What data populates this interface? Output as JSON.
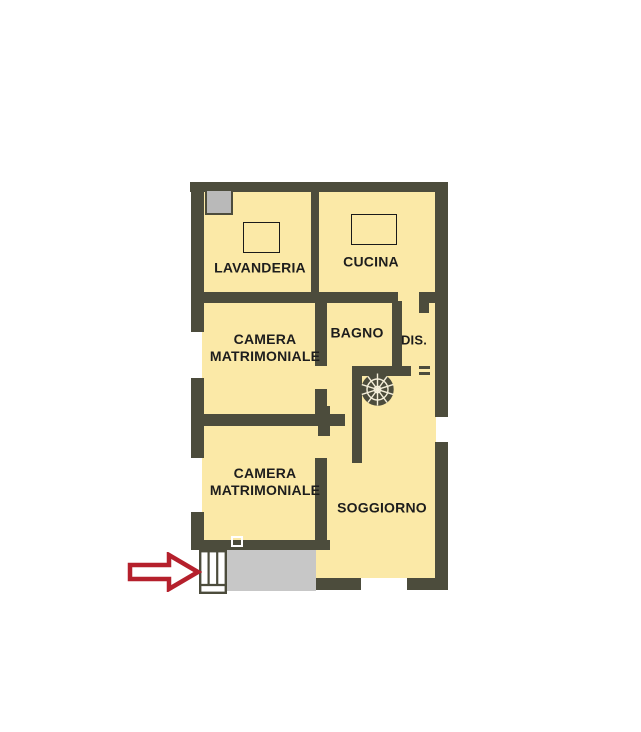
{
  "title": "Apartment floor plan",
  "colors": {
    "wall": "#4c4c3c",
    "room_fill": "#fbe9a7",
    "terrace": "#c7c7c7",
    "appliance": "#b9b9b9",
    "arrow_red": "#b5202c",
    "label_text": "#1d1d1d"
  },
  "rooms": {
    "lavanderia": {
      "label": "LAVANDERIA"
    },
    "cucina": {
      "label": "CUCINA"
    },
    "camera_matrimoniale_1": {
      "line1": "CAMERA",
      "line2": "MATRIMONIALE"
    },
    "bagno": {
      "label": "BAGNO"
    },
    "disimpegno": {
      "label": "DIS."
    },
    "camera_matrimoniale_2": {
      "line1": "CAMERA",
      "line2": "MATRIMONIALE"
    },
    "soggiorno": {
      "label": "SOGGIORNO"
    }
  },
  "icons": {
    "entrance_arrow": "red-block-arrow-right",
    "spiral_staircase": "spiral-staircase-wheel",
    "entry_steps": "entry-steps",
    "appliance_box": "appliance",
    "table_lavanderia": "table-rectangle",
    "table_cucina": "table-rectangle",
    "door_marker": "door-marker-square"
  }
}
